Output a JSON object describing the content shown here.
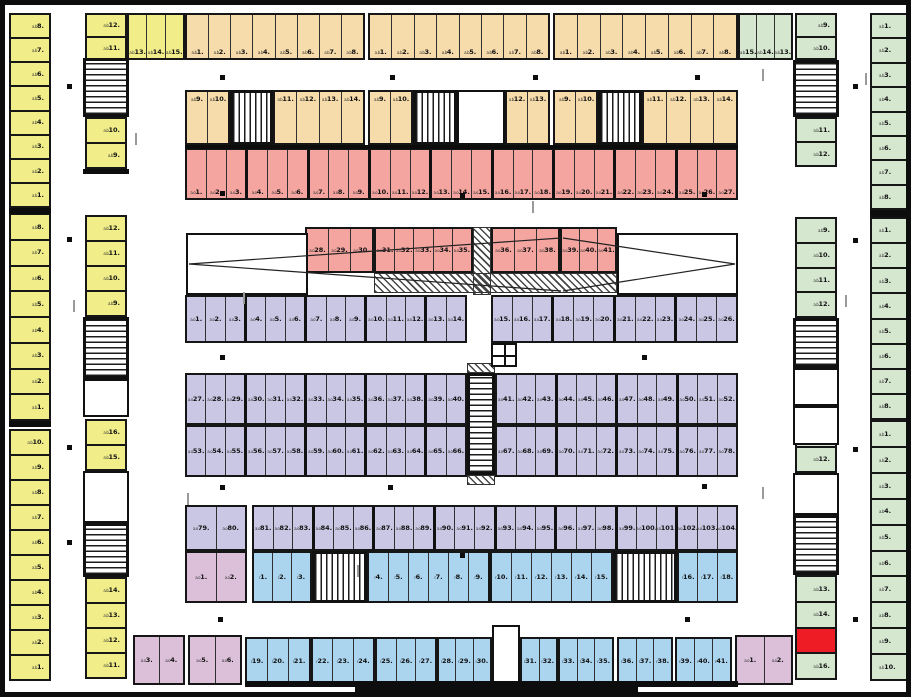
{
  "title": "parking-garage-level-floor-plan",
  "canvas": {
    "width": 911,
    "height": 697
  },
  "colors": {
    "yellow": "#f1ee8a",
    "orange": "#f7dcab",
    "red": "#f4a5a0",
    "purple": "#c9c7e3",
    "blue": "#abd4ef",
    "pink": "#dcc0da",
    "green": "#d6e7d0",
    "highlight": "#ee1c25",
    "wall": "#0d0d0d"
  },
  "prefixes": {
    "ab": "a.b",
    "ao": "a.o",
    "r": "r"
  },
  "bands": [
    {
      "n": "left-edge-block1",
      "c": "yellow",
      "pf": "ab",
      "r": [
        4,
        8,
        42,
        195
      ],
      "d": "v",
      "f": 8,
      "t": 1,
      "lp": "r"
    },
    {
      "n": "left-edge-block2",
      "c": "yellow",
      "pf": "ab",
      "r": [
        4,
        208,
        42,
        208
      ],
      "d": "v",
      "f": 8,
      "t": 1,
      "lp": "r"
    },
    {
      "n": "left-edge-block3",
      "c": "yellow",
      "pf": "ab",
      "r": [
        4,
        424,
        42,
        252
      ],
      "d": "v",
      "f": 10,
      "t": 1,
      "lp": "r"
    },
    {
      "n": "inner-left-1a",
      "c": "yellow",
      "pf": "ab",
      "r": [
        80,
        8,
        42,
        47
      ],
      "d": "v",
      "f": 12,
      "t": 11,
      "lp": "r"
    },
    {
      "n": "inner-left-1b",
      "c": "yellow",
      "pf": "ab",
      "r": [
        122,
        8,
        58,
        47
      ],
      "d": "h",
      "f": 13,
      "t": 15,
      "lp": "b"
    },
    {
      "n": "inner-left-1c",
      "c": "yellow",
      "pf": "ab",
      "r": [
        80,
        112,
        42,
        52
      ],
      "d": "v",
      "f": 10,
      "t": 9,
      "lp": "r"
    },
    {
      "n": "inner-left-2a",
      "c": "yellow",
      "pf": "ab",
      "r": [
        80,
        210,
        42,
        102
      ],
      "d": "v",
      "f": 12,
      "t": 9,
      "lp": "r"
    },
    {
      "n": "inner-left-2b",
      "c": "yellow",
      "pf": "ab",
      "r": [
        80,
        414,
        42,
        52
      ],
      "d": "v",
      "f": 16,
      "t": 15,
      "lp": "r"
    },
    {
      "n": "inner-left-3",
      "c": "yellow",
      "pf": "ab",
      "r": [
        80,
        572,
        42,
        102
      ],
      "d": "v",
      "f": 14,
      "t": 11,
      "lp": "r"
    },
    {
      "n": "top-row1-g1",
      "c": "orange",
      "pf": "ab",
      "r": [
        180,
        8,
        180,
        47
      ],
      "d": "h",
      "f": 1,
      "t": 8,
      "lp": "b"
    },
    {
      "n": "top-row1-g2",
      "c": "orange",
      "pf": "ab",
      "r": [
        363,
        8,
        182,
        47
      ],
      "d": "h",
      "f": 1,
      "t": 8,
      "lp": "b"
    },
    {
      "n": "top-row1-g3",
      "c": "orange",
      "pf": "ab",
      "r": [
        548,
        8,
        185,
        47
      ],
      "d": "h",
      "f": 1,
      "t": 8,
      "lp": "b"
    },
    {
      "n": "top-row2-g1a",
      "c": "orange",
      "pf": "ab",
      "r": [
        180,
        85,
        45,
        55
      ],
      "d": "h",
      "f": 9,
      "t": 10,
      "lp": "t"
    },
    {
      "n": "top-row2-g1b",
      "c": "orange",
      "pf": "ab",
      "r": [
        268,
        85,
        92,
        55
      ],
      "d": "h",
      "f": 11,
      "t": 14,
      "lp": "t"
    },
    {
      "n": "top-row2-g2a",
      "c": "orange",
      "pf": "ab",
      "r": [
        363,
        85,
        45,
        55
      ],
      "d": "h",
      "f": 9,
      "t": 10,
      "lp": "t"
    },
    {
      "n": "top-row2-g2b",
      "c": "orange",
      "pf": "ab",
      "r": [
        500,
        85,
        45,
        55
      ],
      "d": "h",
      "f": 12,
      "t": 13,
      "lp": "t"
    },
    {
      "n": "top-row2-g3a",
      "c": "orange",
      "pf": "ab",
      "r": [
        548,
        85,
        45,
        55
      ],
      "d": "h",
      "f": 9,
      "t": 10,
      "lp": "t"
    },
    {
      "n": "top-row2-g3b",
      "c": "orange",
      "pf": "ab",
      "r": [
        637,
        85,
        96,
        55
      ],
      "d": "h",
      "f": 11,
      "t": 14,
      "lp": "t"
    },
    {
      "n": "red-row",
      "c": "red",
      "pf": "ao",
      "r": [
        180,
        143,
        553,
        52
      ],
      "d": "h",
      "f": 1,
      "t": 27,
      "lp": "b",
      "pil": 3
    },
    {
      "n": "red-mid-a",
      "c": "red",
      "pf": "ao",
      "r": [
        300,
        222,
        69,
        46
      ],
      "d": "h",
      "f": 28,
      "t": 30,
      "lp": "c"
    },
    {
      "n": "red-mid-b",
      "c": "red",
      "pf": "ao",
      "r": [
        369,
        222,
        99,
        46
      ],
      "d": "h",
      "f": 31,
      "t": 35,
      "lp": "c"
    },
    {
      "n": "red-mid-c",
      "c": "red",
      "pf": "ao",
      "r": [
        486,
        222,
        69,
        46
      ],
      "d": "h",
      "f": 36,
      "t": 38,
      "lp": "c"
    },
    {
      "n": "red-mid-d",
      "c": "red",
      "pf": "ao",
      "r": [
        555,
        222,
        57,
        46
      ],
      "d": "h",
      "f": 39,
      "t": 41,
      "lp": "c"
    },
    {
      "n": "purple-row1-a",
      "c": "purple",
      "pf": "ao",
      "r": [
        180,
        290,
        282,
        48
      ],
      "d": "h",
      "f": 1,
      "t": 14,
      "lp": "c",
      "pil": 3
    },
    {
      "n": "purple-row1-b",
      "c": "purple",
      "pf": "ao",
      "r": [
        486,
        290,
        247,
        48
      ],
      "d": "h",
      "f": 15,
      "t": 26,
      "lp": "c",
      "pil": 3
    },
    {
      "n": "purple-row2-a",
      "c": "purple",
      "pf": "ao",
      "r": [
        180,
        368,
        282,
        52
      ],
      "d": "h",
      "f": 27,
      "t": 40,
      "lp": "c",
      "pil": 3
    },
    {
      "n": "purple-row2-b",
      "c": "purple",
      "pf": "ao",
      "r": [
        490,
        368,
        243,
        52
      ],
      "d": "h",
      "f": 41,
      "t": 52,
      "lp": "c",
      "pil": 3
    },
    {
      "n": "purple-row3-a",
      "c": "purple",
      "pf": "ao",
      "r": [
        180,
        420,
        282,
        52
      ],
      "d": "h",
      "f": 53,
      "t": 66,
      "lp": "c",
      "pil": 3
    },
    {
      "n": "purple-row3-b",
      "c": "purple",
      "pf": "ao",
      "r": [
        490,
        420,
        243,
        52
      ],
      "d": "h",
      "f": 67,
      "t": 78,
      "lp": "c",
      "pil": 3
    },
    {
      "n": "purple-row4-a",
      "c": "purple",
      "pf": "ao",
      "r": [
        180,
        500,
        62,
        46
      ],
      "d": "h",
      "f": 79,
      "t": 80,
      "lp": "c"
    },
    {
      "n": "purple-row4-b",
      "c": "purple",
      "pf": "ao",
      "r": [
        247,
        500,
        486,
        46
      ],
      "d": "h",
      "f": 81,
      "t": 104,
      "lp": "c",
      "pil": 3
    },
    {
      "n": "pink-left",
      "c": "pink",
      "pf": "ao",
      "r": [
        180,
        546,
        62,
        52
      ],
      "d": "h",
      "f": 1,
      "t": 2,
      "lp": "c"
    },
    {
      "n": "blue-row1-a",
      "c": "blue",
      "pf": "r",
      "r": [
        247,
        546,
        60,
        52
      ],
      "d": "h",
      "f": 1,
      "t": 3,
      "lp": "c"
    },
    {
      "n": "blue-row1-b",
      "c": "blue",
      "pf": "r",
      "r": [
        362,
        546,
        123,
        52
      ],
      "d": "h",
      "f": 4,
      "t": 9,
      "lp": "c"
    },
    {
      "n": "blue-row1-c",
      "c": "blue",
      "pf": "r",
      "r": [
        485,
        546,
        123,
        52
      ],
      "d": "h",
      "f": 10,
      "t": 15,
      "lp": "c"
    },
    {
      "n": "blue-row1-d",
      "c": "blue",
      "pf": "r",
      "r": [
        672,
        546,
        61,
        52
      ],
      "d": "h",
      "f": 16,
      "t": 18,
      "lp": "c"
    },
    {
      "n": "pink-bottom-a",
      "c": "pink",
      "pf": "ao",
      "r": [
        128,
        630,
        52,
        50
      ],
      "d": "h",
      "f": 3,
      "t": 4,
      "lp": "c"
    },
    {
      "n": "pink-bottom-b",
      "c": "pink",
      "pf": "ao",
      "r": [
        183,
        630,
        54,
        50
      ],
      "d": "h",
      "f": 5,
      "t": 6,
      "lp": "c"
    },
    {
      "n": "blue-row2-a",
      "c": "blue",
      "pf": "r",
      "r": [
        240,
        632,
        66,
        48
      ],
      "d": "h",
      "f": 19,
      "t": 21,
      "lp": "c"
    },
    {
      "n": "blue-row2-b",
      "c": "blue",
      "pf": "r",
      "r": [
        306,
        632,
        64,
        48
      ],
      "d": "h",
      "f": 22,
      "t": 24,
      "lp": "c"
    },
    {
      "n": "blue-row2-c",
      "c": "blue",
      "pf": "r",
      "r": [
        370,
        632,
        62,
        48
      ],
      "d": "h",
      "f": 25,
      "t": 27,
      "lp": "c"
    },
    {
      "n": "blue-row2-d",
      "c": "blue",
      "pf": "r",
      "r": [
        432,
        632,
        55,
        48
      ],
      "d": "h",
      "f": 28,
      "t": 30,
      "lp": "c"
    },
    {
      "n": "blue-row2-e",
      "c": "blue",
      "pf": "r",
      "r": [
        515,
        632,
        38,
        48
      ],
      "d": "h",
      "f": 31,
      "t": 32,
      "lp": "c"
    },
    {
      "n": "blue-row2-f",
      "c": "blue",
      "pf": "r",
      "r": [
        553,
        632,
        56,
        48
      ],
      "d": "h",
      "f": 33,
      "t": 35,
      "lp": "c"
    },
    {
      "n": "blue-row2-g",
      "c": "blue",
      "pf": "r",
      "r": [
        612,
        632,
        56,
        48
      ],
      "d": "h",
      "f": 36,
      "t": 38,
      "lp": "c"
    },
    {
      "n": "blue-row2-h",
      "c": "blue",
      "pf": "r",
      "r": [
        670,
        632,
        57,
        48
      ],
      "d": "h",
      "f": 39,
      "t": 41,
      "lp": "c"
    },
    {
      "n": "pink-bottom-right",
      "c": "pink",
      "pf": "ao",
      "r": [
        730,
        630,
        58,
        50
      ],
      "d": "h",
      "f": 1,
      "t": 2,
      "lp": "c"
    },
    {
      "n": "inner-right-1a",
      "c": "green",
      "pf": "ab",
      "r": [
        733,
        8,
        55,
        47
      ],
      "d": "h",
      "f": 15,
      "t": 13,
      "lp": "b"
    },
    {
      "n": "inner-right-1b",
      "c": "green",
      "pf": "ab",
      "r": [
        790,
        8,
        42,
        47
      ],
      "d": "v",
      "f": 9,
      "t": 10,
      "lp": "r"
    },
    {
      "n": "inner-right-1c",
      "c": "green",
      "pf": "ab",
      "r": [
        790,
        112,
        42,
        50
      ],
      "d": "v",
      "f": 11,
      "t": 12,
      "lp": "r"
    },
    {
      "n": "inner-right-2",
      "c": "green",
      "pf": "ab",
      "r": [
        790,
        212,
        42,
        101
      ],
      "d": "v",
      "f": 9,
      "t": 12,
      "lp": "r"
    },
    {
      "n": "inner-right-3a",
      "c": "green",
      "pf": "ab",
      "r": [
        790,
        415,
        42,
        53
      ],
      "d": "v",
      "f": 11,
      "t": 12,
      "lp": "r"
    },
    {
      "n": "inner-right-3b",
      "c": "green",
      "pf": "ab",
      "r": [
        790,
        570,
        42,
        105
      ],
      "d": "v",
      "labels": [
        "13",
        "14",
        "*",
        "16"
      ],
      "lp": "r"
    },
    {
      "n": "right-edge-block1",
      "c": "green",
      "pf": "ab",
      "r": [
        865,
        8,
        44,
        197
      ],
      "d": "v",
      "f": 1,
      "t": 8,
      "lp": "l"
    },
    {
      "n": "right-edge-block2",
      "c": "green",
      "pf": "ab",
      "r": [
        865,
        212,
        44,
        203
      ],
      "d": "v",
      "f": 1,
      "t": 8,
      "lp": "l"
    },
    {
      "n": "right-edge-block3",
      "c": "green",
      "pf": "ab",
      "r": [
        865,
        415,
        44,
        261
      ],
      "d": "v",
      "f": 1,
      "t": 10,
      "lp": "l"
    }
  ],
  "stairs": [
    {
      "r": [
        78,
        53,
        46,
        59
      ],
      "o": "v"
    },
    {
      "r": [
        225,
        85,
        43,
        55
      ],
      "o": "h"
    },
    {
      "r": [
        408,
        85,
        44,
        55
      ],
      "o": "h"
    },
    {
      "r": [
        593,
        85,
        44,
        55
      ],
      "o": "h"
    },
    {
      "r": [
        788,
        55,
        46,
        57
      ],
      "o": "v"
    },
    {
      "r": [
        78,
        312,
        46,
        62
      ],
      "o": "v"
    },
    {
      "r": [
        788,
        313,
        46,
        50
      ],
      "o": "v"
    },
    {
      "r": [
        78,
        518,
        46,
        54
      ],
      "o": "v"
    },
    {
      "r": [
        788,
        510,
        46,
        60
      ],
      "o": "v"
    },
    {
      "r": [
        307,
        546,
        55,
        52
      ],
      "o": "h"
    },
    {
      "r": [
        608,
        546,
        64,
        52
      ],
      "o": "h"
    },
    {
      "r": [
        462,
        368,
        28,
        102
      ],
      "o": "v"
    }
  ],
  "rooms": [
    [
      452,
      85,
      48,
      55
    ],
    [
      78,
      374,
      46,
      38
    ],
    [
      78,
      466,
      46,
      52
    ],
    [
      788,
      363,
      46,
      38
    ],
    [
      788,
      401,
      46,
      39
    ],
    [
      788,
      468,
      46,
      42
    ],
    [
      487,
      620,
      28,
      58
    ],
    [
      181,
      228,
      122,
      62
    ],
    [
      612,
      228,
      121,
      62
    ]
  ],
  "hatches": [
    [
      468,
      222,
      18,
      68
    ],
    [
      369,
      268,
      243,
      20
    ],
    [
      462,
      358,
      28,
      10
    ],
    [
      462,
      470,
      28,
      10
    ]
  ],
  "walls": [
    [
      4,
      203,
      42,
      6
    ],
    [
      4,
      416,
      42,
      6
    ],
    [
      865,
      205,
      44,
      7
    ],
    [
      78,
      164,
      46,
      5
    ],
    [
      180,
      140,
      553,
      4
    ],
    [
      240,
      676,
      493,
      6
    ],
    [
      350,
      682,
      283,
      9
    ]
  ],
  "ramp_lines": [
    [
      184,
      259,
      556,
      233
    ],
    [
      184,
      259,
      556,
      286
    ],
    [
      730,
      259,
      558,
      233
    ],
    [
      730,
      259,
      558,
      286
    ]
  ],
  "elevator_glyph": [
    486,
    338,
    26,
    24
  ],
  "dots": [
    [
      62,
      79
    ],
    [
      62,
      232
    ],
    [
      62,
      440
    ],
    [
      62,
      535
    ],
    [
      215,
      70
    ],
    [
      385,
      70
    ],
    [
      528,
      70
    ],
    [
      690,
      70
    ],
    [
      848,
      79
    ],
    [
      848,
      233
    ],
    [
      848,
      442
    ],
    [
      215,
      186
    ],
    [
      455,
      188
    ],
    [
      697,
      187
    ],
    [
      215,
      350
    ],
    [
      637,
      350
    ],
    [
      215,
      480
    ],
    [
      383,
      480
    ],
    [
      697,
      479
    ],
    [
      455,
      548
    ],
    [
      213,
      612
    ],
    [
      680,
      612
    ],
    [
      848,
      612
    ]
  ],
  "ticks": [
    [
      130,
      128
    ],
    [
      238,
      287
    ],
    [
      527,
      196
    ],
    [
      757,
      64
    ],
    [
      840,
      290
    ],
    [
      182,
      488
    ],
    [
      757,
      482
    ],
    [
      352,
      560
    ],
    [
      860,
      68
    ],
    [
      68,
      295
    ]
  ]
}
